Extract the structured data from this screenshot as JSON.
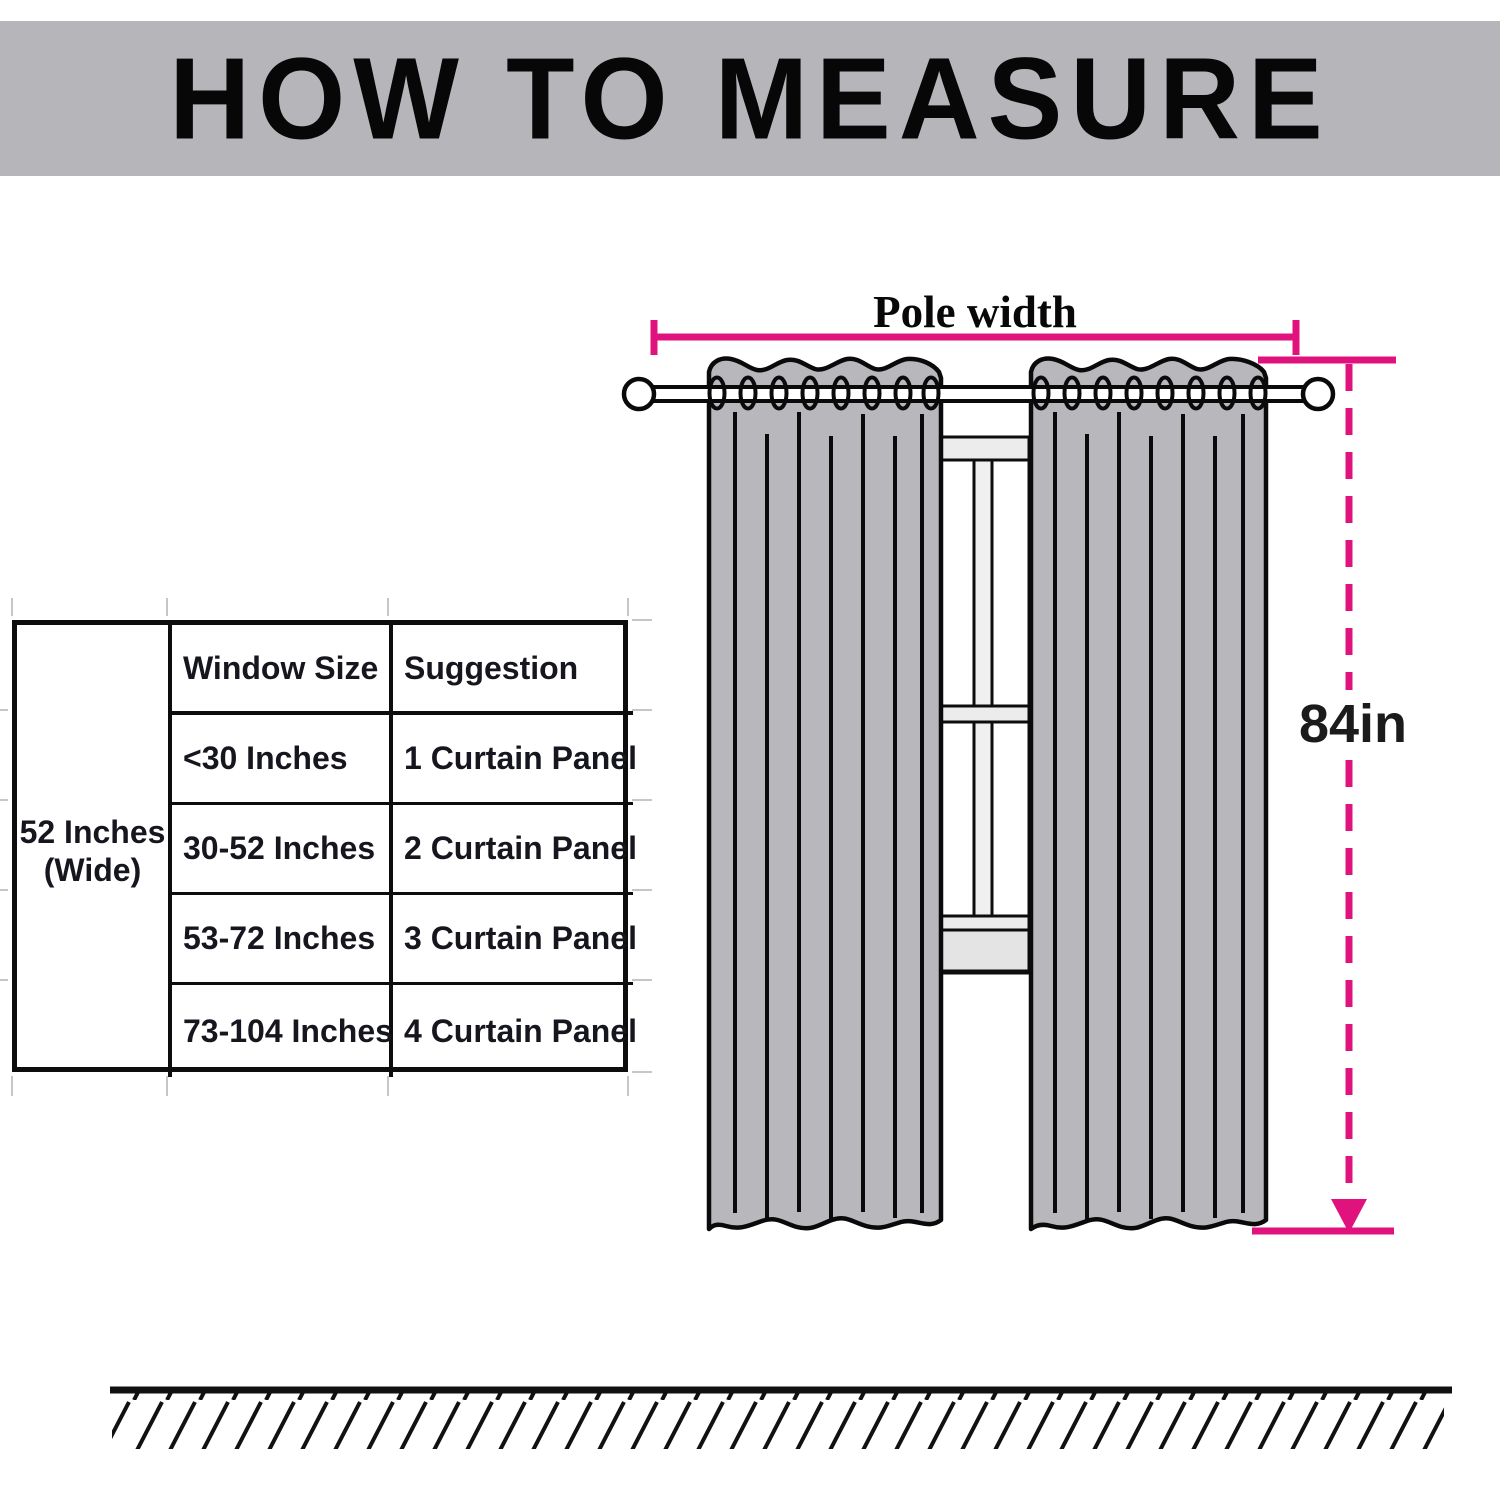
{
  "header": {
    "title": "HOW TO MEASURE"
  },
  "size_table": {
    "width_label_line1": "52 Inches",
    "width_label_line2": "(Wide)",
    "columns": [
      "Window Size",
      "Suggestion"
    ],
    "rows": [
      {
        "window_size": "<30 Inches",
        "suggestion": "1 Curtain Panel"
      },
      {
        "window_size": "30-52 Inches",
        "suggestion": "2 Curtain Panel"
      },
      {
        "window_size": "53-72 Inches",
        "suggestion": "3 Curtain Panel"
      },
      {
        "window_size": "73-104 Inches",
        "suggestion": "4 Curtain Panel"
      }
    ]
  },
  "diagram": {
    "pole_width_label": "Pole width",
    "height_label": "84in"
  },
  "colors": {
    "accent_pink": "#e0137e",
    "banner_gray": "#b5b5ba",
    "curtain_gray": "#b7b7bc",
    "window_gray": "#ececec",
    "line_black": "#0d0d0d"
  }
}
